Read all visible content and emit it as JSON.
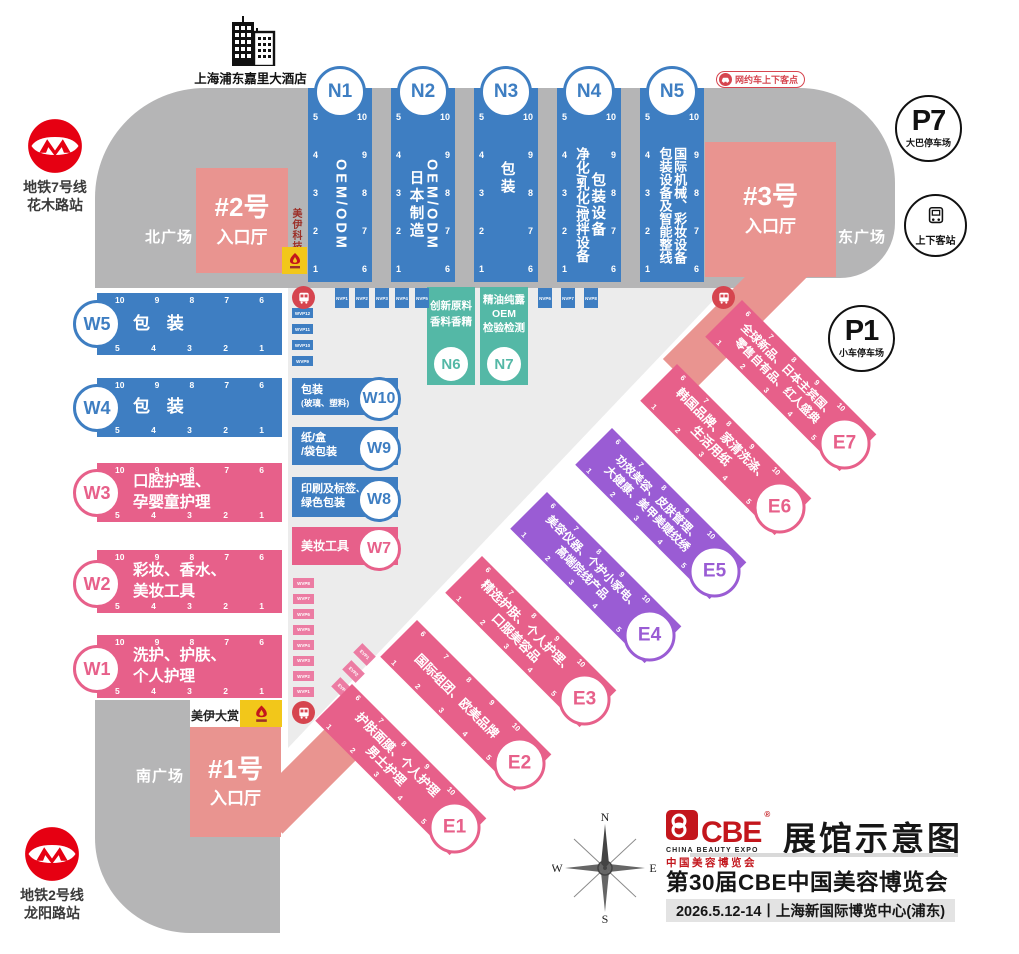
{
  "meta": {
    "map_title": "展馆示意图",
    "expo_title": "第30届CBE中国美容博览会",
    "date_venue": "2026.5.12-14丨上海新国际博览中心(浦东)"
  },
  "logo": {
    "name": "CBE",
    "reg": "®",
    "sub_en": "CHINA BEAUTY EXPO",
    "sub_cn": "中国美容博览会"
  },
  "hotel": {
    "label": "上海浦东嘉里大酒店"
  },
  "metro_north": {
    "line1": "地铁7号线",
    "line2": "花木路站"
  },
  "metro_south": {
    "line1": "地铁2号线",
    "line2": "龙阳路站"
  },
  "squares": {
    "north": "北广场",
    "east": "东广场",
    "south": "南广场"
  },
  "entrances": {
    "no1": {
      "line1": "#1号",
      "line2": "入口厅"
    },
    "no2": {
      "line1": "#2号",
      "line2": "入口厅"
    },
    "no3": {
      "line1": "#3号",
      "line2": "入口厅"
    }
  },
  "parking": {
    "p7": {
      "code": "P7",
      "label": "大巴停车场"
    },
    "p1": {
      "code": "P1",
      "label": "小车停车场"
    },
    "dropoff": {
      "label": "上下客站"
    },
    "rideshare": {
      "label": "网约车上下客点"
    }
  },
  "sponsors": {
    "tech": "美伊科技",
    "award": "美伊大赏"
  },
  "compass": {
    "n": "N",
    "e": "E",
    "s": "S",
    "w": "W"
  },
  "hall_numbers": {
    "n_left": [
      "5",
      "4",
      "3",
      "2",
      "1"
    ],
    "n_right": [
      "10",
      "9",
      "8",
      "7",
      "6"
    ],
    "w_top": [
      "10",
      "9",
      "8",
      "7",
      "6"
    ],
    "w_bottom": [
      "5",
      "4",
      "3",
      "2",
      "1"
    ],
    "e_top": [
      "6",
      "7",
      "8",
      "9",
      "10"
    ],
    "e_bottom": [
      "1",
      "2",
      "3",
      "4",
      "5"
    ]
  },
  "stops": {
    "n_row": [
      "NVP1",
      "NVP2",
      "NVP3",
      "NVP4",
      "NVP5"
    ],
    "n_row_right": [
      "NVP6",
      "NVP7",
      "NVP8"
    ],
    "w_stack_top": [
      "WVP12",
      "WVP11",
      "WVP10",
      "WVP9"
    ],
    "w_stack_bottom": [
      "WVP8",
      "WVP7",
      "WVP6",
      "WVP5",
      "WVP4",
      "WVP3",
      "WVP2",
      "WVP1"
    ],
    "e_cluster": [
      "EVP1",
      "EVP2",
      "EVP3"
    ]
  },
  "halls": {
    "N1": {
      "code": "N1",
      "lines": [
        "OEM/ODM"
      ]
    },
    "N2": {
      "code": "N2",
      "lines": [
        "OEM/ODM",
        "日本制造"
      ]
    },
    "N3": {
      "code": "N3",
      "lines": [
        "包装"
      ]
    },
    "N4": {
      "code": "N4",
      "lines": [
        "包装设备",
        "净化/乳化/搅拌设备"
      ]
    },
    "N5": {
      "code": "N5",
      "lines": [
        "国际机械、彩妆设备",
        "包装设备及智能整线"
      ]
    },
    "N6": {
      "code": "N6",
      "lines": [
        "创新原料",
        "香料香精"
      ]
    },
    "N7": {
      "code": "N7",
      "lines": [
        "精油纯露",
        "OEM",
        "检验检测"
      ]
    },
    "W1": {
      "code": "W1",
      "lines": [
        "洗护、护肤、",
        "个人护理"
      ]
    },
    "W2": {
      "code": "W2",
      "lines": [
        "彩妆、香水、",
        "美妆工具"
      ]
    },
    "W3": {
      "code": "W3",
      "lines": [
        "口腔护理、",
        "孕婴童护理"
      ]
    },
    "W4": {
      "code": "W4",
      "lines": [
        "包 装"
      ]
    },
    "W5": {
      "code": "W5",
      "lines": [
        "包 装"
      ]
    },
    "W7": {
      "code": "W7",
      "lines": [
        "美妆工具"
      ]
    },
    "W8": {
      "code": "W8",
      "lines": [
        "印刷及标签、",
        "绿色包装"
      ]
    },
    "W9": {
      "code": "W9",
      "lines": [
        "纸/盒",
        "/袋包装"
      ]
    },
    "W10": {
      "code": "W10",
      "lines": [
        "包装",
        "(玻璃、塑料)"
      ]
    },
    "E1": {
      "code": "E1",
      "lines": [
        "护肤面膜、个人护理",
        "男士护理"
      ]
    },
    "E2": {
      "code": "E2",
      "lines": [
        "国际组团、欧美品牌"
      ]
    },
    "E3": {
      "code": "E3",
      "lines": [
        "精选护肤、个人护理、",
        "口服美容品"
      ]
    },
    "E4": {
      "code": "E4",
      "lines": [
        "美容仪器、个护小家电、",
        "高端院线产品"
      ]
    },
    "E5": {
      "code": "E5",
      "lines": [
        "功效美容、皮肤管理、",
        "大健康、美甲美睫纹绣"
      ]
    },
    "E6": {
      "code": "E6",
      "lines": [
        "韩国品牌、家清洗涤、",
        "生活用纸"
      ]
    },
    "E7": {
      "code": "E7",
      "lines": [
        "全球新品、日本主宾国、",
        "零售自有品、红人盛典"
      ]
    }
  }
}
